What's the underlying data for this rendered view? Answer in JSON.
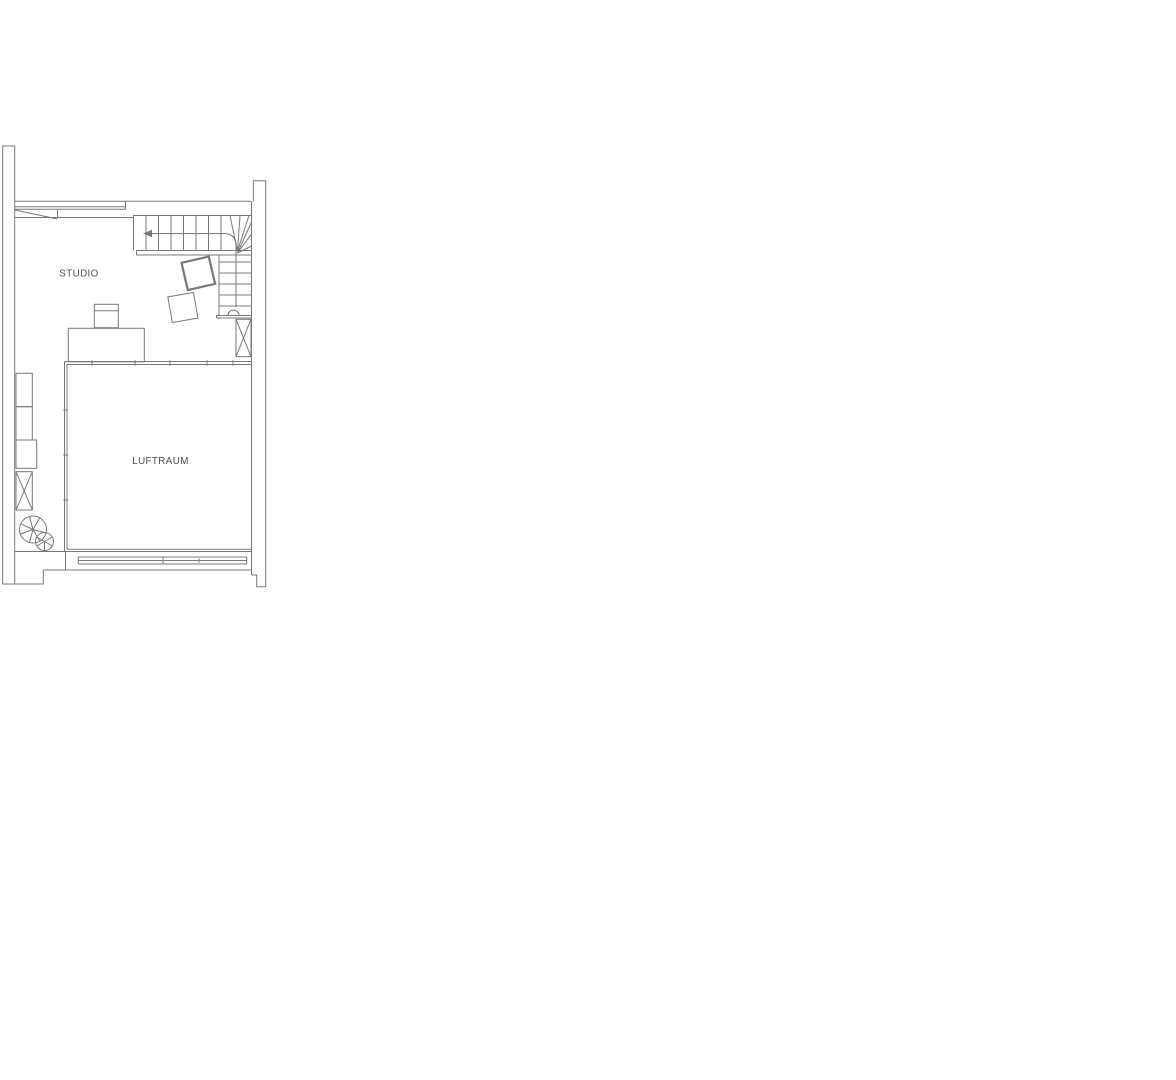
{
  "document": {
    "kind": "architectural-floor-plan",
    "background": "#ffffff"
  },
  "colors": {
    "line": "#787878",
    "text": "#4d4d4d"
  },
  "rooms": [
    {
      "id": "studio",
      "label": "STUDIO"
    },
    {
      "id": "luftraum",
      "label": "LUFTRAUM"
    }
  ],
  "symbols": [
    "staircase-with-winders",
    "stair-direction-arrow",
    "walk-line-start-circle",
    "void-railing",
    "duct-shaft-x-right",
    "duct-shaft-x-left",
    "desk",
    "desk-chair",
    "tilted-armchair-upper",
    "tilted-armchair-lower",
    "wall-cabinets",
    "plant",
    "window-band-top",
    "window-band-bottom",
    "roof-slope-line"
  ]
}
